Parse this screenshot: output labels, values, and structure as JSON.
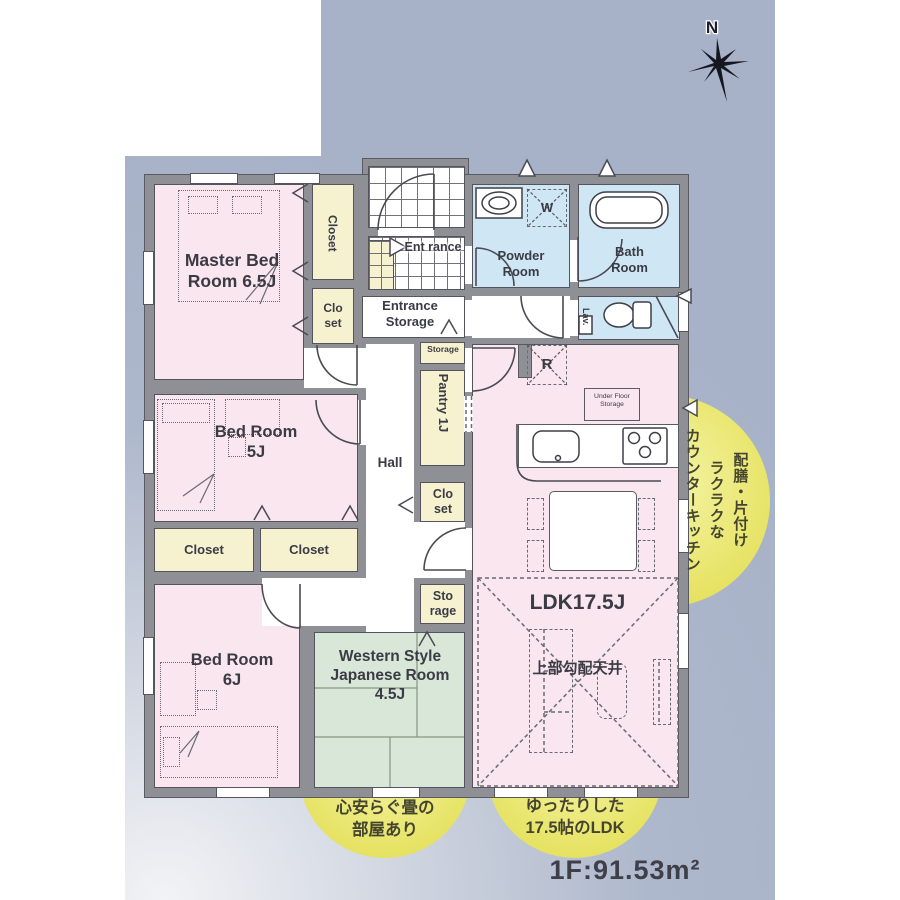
{
  "compass": {
    "north_label": "N"
  },
  "floor_area_label": "1F:91.53m²",
  "rooms": {
    "master_bedroom": {
      "label": "Master Bed Room 6.5J"
    },
    "bedroom_5j": {
      "label": "Bed Room 5J"
    },
    "bedroom_6j": {
      "label": "Bed Room 6J"
    },
    "japanese_room": {
      "label": "Western Style Japanese Room 4.5J"
    },
    "ldk": {
      "label": "LDK17.5J",
      "ceiling_note": "上部勾配天井"
    },
    "hall": {
      "label": "Hall"
    },
    "entrance": {
      "label": "Ent rance"
    },
    "entrance_storage": {
      "label": "Entrance Storage"
    },
    "powder_room": {
      "label": "Powder Room"
    },
    "bath_room": {
      "label": "Bath Room"
    },
    "lavatory": {
      "label": "Lav."
    },
    "pantry": {
      "label": "Pantry 1J"
    },
    "closet_master_large": {
      "label": "Closet"
    },
    "closet_master_small": {
      "label": "Clo set"
    },
    "closet_bed5_left": {
      "label": "Closet"
    },
    "closet_bed5_right": {
      "label": "Closet"
    },
    "closet_hall": {
      "label": "Clo set"
    },
    "storage_kitchen": {
      "label": "Storage"
    },
    "storage_hall": {
      "label": "Sto rage"
    },
    "under_floor_storage": {
      "label": "Under Floor Storage"
    },
    "washing_machine": {
      "label": "W"
    },
    "refrigerator": {
      "label": "R"
    }
  },
  "callouts": {
    "counter_kitchen": {
      "col_left": "カウンターキッチン",
      "col_middle": "ラクラクな",
      "col_right": "配膳・片付け"
    },
    "tatami": {
      "line1": "心安らぐ畳の",
      "line2": "部屋あり"
    },
    "spacious_ldk": {
      "line1": "ゆったりした",
      "line2": "17.5帖のLDK"
    }
  },
  "colors": {
    "background_blue": "#a7b1c7",
    "room_pink": "#f9e6ee",
    "room_blue": "#cfe7f5",
    "room_cream": "#f6f2d0",
    "room_green": "#d9e7d9",
    "wall_gray": "#8f9096",
    "callout_yellow": "#e5e05c"
  }
}
